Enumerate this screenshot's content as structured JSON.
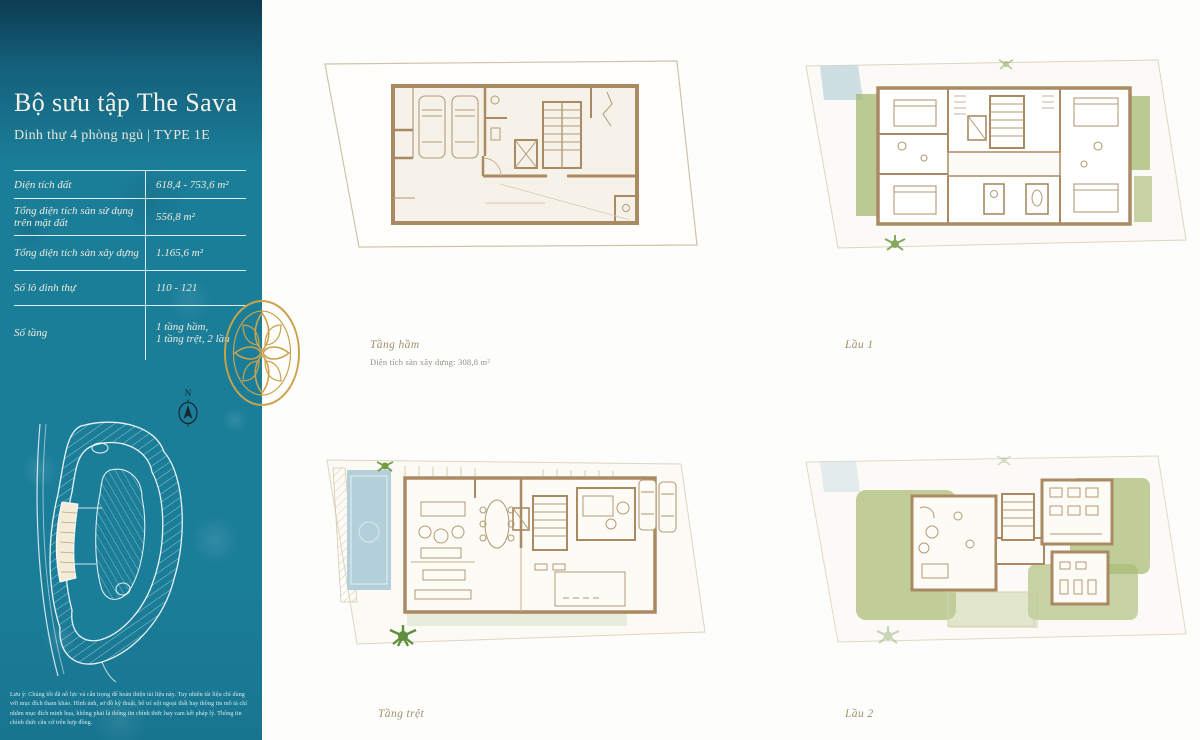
{
  "sidebar": {
    "title": "Bộ sưu tập The Sava",
    "subtitle": "Dinh thự 4 phòng ngủ | TYPE 1E",
    "specs": [
      {
        "label": "Diện tích đất",
        "value": "618,4 - 753,6 m²"
      },
      {
        "label": "Tổng diện tích sàn sử dụng trên mặt đất",
        "value": "556,8 m²"
      },
      {
        "label": "Tổng diện tích sàn xây dựng",
        "value": "1.165,6 m²"
      },
      {
        "label": "Số lô dinh thự",
        "value": "110 - 121"
      },
      {
        "label": "Số tầng",
        "value": "1 tầng hầm,\n1 tầng trệt, 2 lầu"
      }
    ],
    "compass_label": "N",
    "disclaimer": "Lưu ý: Chúng tôi đã nỗ lực và cẩn trọng để hoàn thiện tài liệu này. Tuy nhiên tài liệu chỉ dùng với mục đích tham khảo. Hình ảnh, sơ đồ kỹ thuật, bố trí nội ngoại thất hay thông tin mô tả chỉ nhằm mục đích minh họa, không phải là thông tin chính thức hay cam kết pháp lý. Thông tin chính thức căn cứ trên hợp đồng."
  },
  "plans": [
    {
      "id": "tang-ham",
      "label": "Tầng hầm",
      "area_note": "Diện tích sàn xây dựng: 308,8 m²"
    },
    {
      "id": "lau-1",
      "label": "Lầu 1"
    },
    {
      "id": "tang-tret",
      "label": "Tầng trệt"
    },
    {
      "id": "lau-2",
      "label": "Lầu 2"
    }
  ],
  "colors": {
    "sidebar_teal": "#1b7e99",
    "accent_gold": "#c9a24b",
    "wall_brown": "#a98a63",
    "lot_line": "#cfc4ab",
    "floor_cream": "#f7f2e9",
    "landscape_green": "#a6b970",
    "pool_blue": "#b3cfda"
  }
}
